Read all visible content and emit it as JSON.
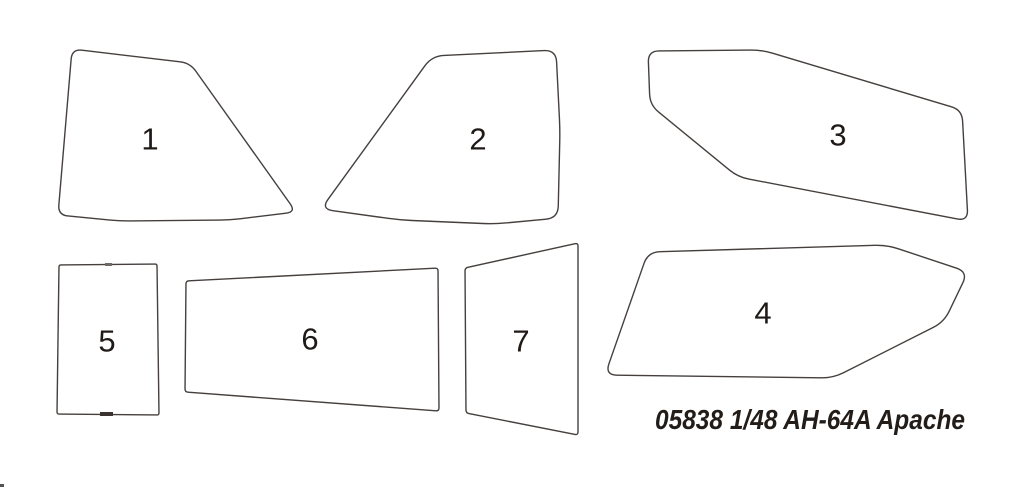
{
  "canvas": {
    "width": 1024,
    "height": 489,
    "background": "#ffffff"
  },
  "style": {
    "outline_color": "#45403d",
    "outline_width": 1.4,
    "label_color": "#1f1a17",
    "label_font_size": 31,
    "caption_color": "#231d1a"
  },
  "caption": {
    "text": "05838 1/48 AH-64A Apache",
    "x_end": 965,
    "baseline_y": 429,
    "font_size": 28,
    "text_length": 310
  },
  "parts": [
    {
      "number": "1",
      "label": {
        "x": 150,
        "y": 139
      },
      "corner_radius": 10,
      "outline": [
        [
          72,
          49
        ],
        [
          190,
          63
        ],
        [
          296,
          212
        ],
        [
          230,
          220
        ],
        [
          120,
          221
        ],
        [
          58,
          215
        ]
      ]
    },
    {
      "number": "2",
      "label": {
        "x": 478,
        "y": 139
      },
      "corner_radius": 12,
      "outline": [
        [
          432,
          56
        ],
        [
          556,
          50
        ],
        [
          560,
          130
        ],
        [
          558,
          218
        ],
        [
          495,
          224
        ],
        [
          400,
          220
        ],
        [
          321,
          209
        ]
      ]
    },
    {
      "number": "3",
      "label": {
        "x": 838,
        "y": 135
      },
      "corner_radius": 11,
      "outline": [
        [
          648,
          51
        ],
        [
          762,
          50
        ],
        [
          962,
          110
        ],
        [
          968,
          221
        ],
        [
          738,
          177
        ],
        [
          650,
          105
        ]
      ]
    },
    {
      "number": "4",
      "label": {
        "x": 763,
        "y": 313
      },
      "corner_radius": 12,
      "outline": [
        [
          648,
          252
        ],
        [
          887,
          245
        ],
        [
          968,
          272
        ],
        [
          944,
          322
        ],
        [
          833,
          378
        ],
        [
          605,
          375
        ]
      ]
    },
    {
      "number": "5",
      "label": {
        "x": 107,
        "y": 341
      },
      "corner_radius": 2,
      "outline": [
        [
          59,
          265
        ],
        [
          157,
          264
        ],
        [
          159,
          415
        ],
        [
          57,
          414
        ]
      ]
    },
    {
      "number": "6",
      "label": {
        "x": 310,
        "y": 339
      },
      "corner_radius": 3,
      "outline": [
        [
          186,
          281
        ],
        [
          438,
          268
        ],
        [
          439,
          411
        ],
        [
          185,
          392
        ]
      ]
    },
    {
      "number": "7",
      "label": {
        "x": 521,
        "y": 341
      },
      "corner_radius": 3,
      "outline": [
        [
          465,
          268
        ],
        [
          578,
          243
        ],
        [
          578,
          435
        ],
        [
          466,
          413
        ]
      ]
    }
  ],
  "marks": [
    {
      "name": "gate-mark-top",
      "x": 105,
      "y": 263,
      "width": 7,
      "height": 3,
      "color": "#6e6a66"
    },
    {
      "name": "gate-mark-bottom",
      "x": 100,
      "y": 412,
      "width": 13,
      "height": 4,
      "color": "#3a3330"
    },
    {
      "name": "stray-mark",
      "x": 0,
      "y": 484,
      "width": 4,
      "height": 3,
      "color": "#575250"
    }
  ]
}
